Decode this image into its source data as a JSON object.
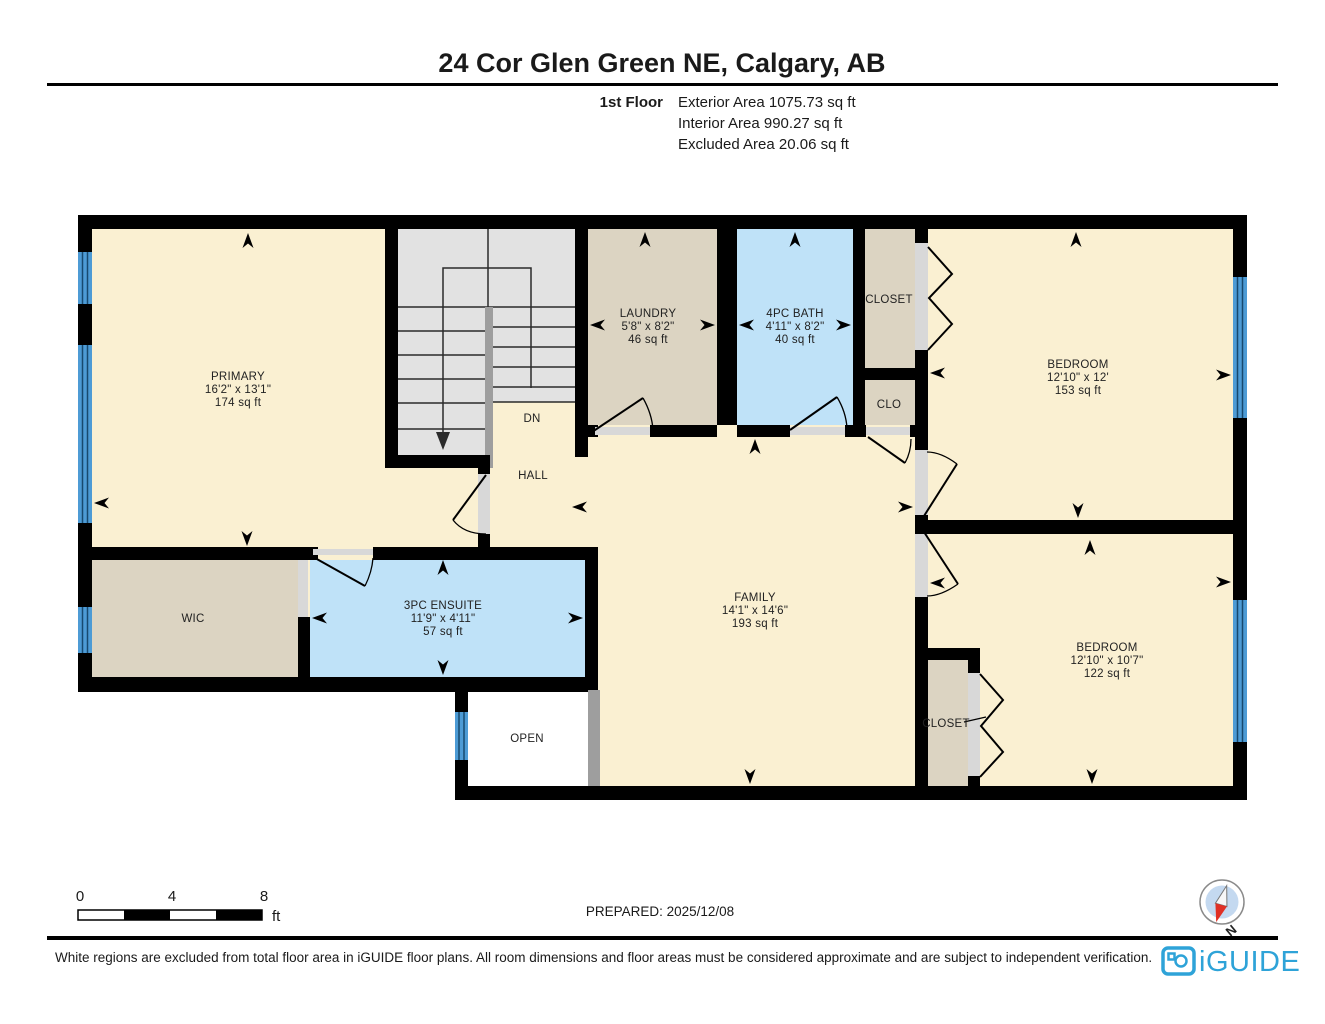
{
  "header": {
    "title": "24 Cor Glen Green NE, Calgary, AB",
    "floor_label": "1st Floor",
    "stats": {
      "exterior": "Exterior Area 1075.73 sq ft",
      "interior": "Interior Area 990.27 sq ft",
      "excluded": "Excluded Area 20.06 sq ft"
    }
  },
  "rooms": {
    "primary": {
      "name": "PRIMARY",
      "dims": "16'2\" x 13'1\"",
      "area": "174 sq ft"
    },
    "laundry": {
      "name": "LAUNDRY",
      "dims": "5'8\" x 8'2\"",
      "area": "46 sq ft"
    },
    "bath": {
      "name": "4PC BATH",
      "dims": "4'11\" x 8'2\"",
      "area": "40 sq ft"
    },
    "closet_top": {
      "name": "CLOSET"
    },
    "clo": {
      "name": "CLO"
    },
    "bedroom_ne": {
      "name": "BEDROOM",
      "dims": "12'10\" x 12'",
      "area": "153 sq ft"
    },
    "stairs": {
      "name": "DN"
    },
    "hall": {
      "name": "HALL"
    },
    "family": {
      "name": "FAMILY",
      "dims": "14'1\" x 14'6\"",
      "area": "193 sq ft"
    },
    "wic": {
      "name": "WIC"
    },
    "ensuite": {
      "name": "3PC ENSUITE",
      "dims": "11'9\" x 4'11\"",
      "area": "57 sq ft"
    },
    "open": {
      "name": "OPEN"
    },
    "bedroom_se": {
      "name": "BEDROOM",
      "dims": "12'10\" x 10'7\"",
      "area": "122 sq ft"
    },
    "closet_bot": {
      "name": "CLOSET"
    }
  },
  "scale_bar": {
    "tick_0": "0",
    "tick_4": "4",
    "tick_8": "8",
    "unit": "ft"
  },
  "prepared": "PREPARED: 2025/12/08",
  "compass": {
    "north_label": "N"
  },
  "footer": {
    "disclaimer": "White regions are excluded from total floor area in iGUIDE floor plans. All room dimensions and floor areas must be considered approximate and are subject to independent verification.",
    "brand": "iGUIDE"
  },
  "colors": {
    "room_cream": "#FAF0D2",
    "room_tan": "#DCD4C2",
    "room_blue": "#BFE2F8",
    "stairs_gray": "#E2E2E2",
    "window_blue": "#4D9BD5",
    "wall_black": "#000000",
    "brand_blue": "#2EA3D8",
    "compass_red": "#E03025"
  }
}
